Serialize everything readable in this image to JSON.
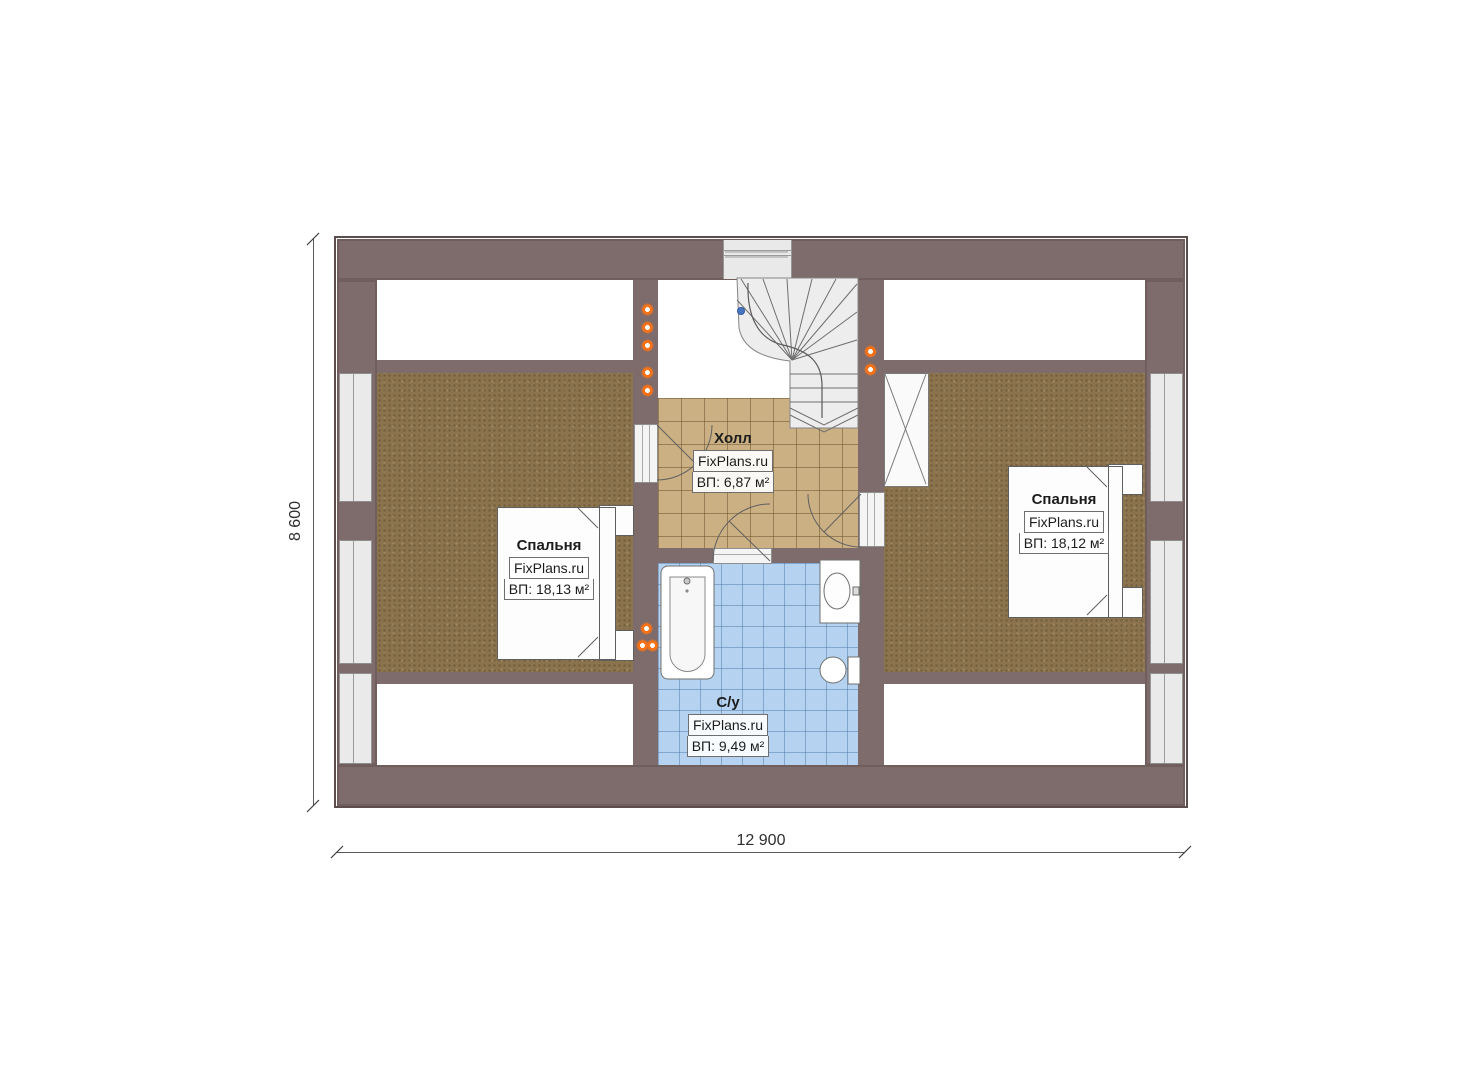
{
  "plan": {
    "type": "floor-plan",
    "rooms": {
      "bedroom_left": {
        "name": "Спальня",
        "brand": "FixPlans.ru",
        "area": "ВП: 18,13 м²"
      },
      "bedroom_right": {
        "name": "Спальня",
        "brand": "FixPlans.ru",
        "area": "ВП: 18,12 м²"
      },
      "hall": {
        "name": "Холл",
        "brand": "FixPlans.ru",
        "area": "ВП: 6,87 м²"
      },
      "bathroom": {
        "name": "С/у",
        "brand": "FixPlans.ru",
        "area": "ВП: 9,49 м²"
      }
    },
    "dimensions": {
      "height_label": "8 600",
      "width_label": "12 900"
    },
    "colors": {
      "wall": "#7e6b6b",
      "bedroom_floor": "#8a734d",
      "hall_tile": "#cbb084",
      "bathroom_tile": "#b5d3f1",
      "downlight": "#f97316",
      "walk_node": "#4a77c4"
    },
    "icons": {
      "downlight": "orange ceiling spot dot",
      "walk_node": "blue stair walk-line node",
      "stair_arrow": "double chevron at stair foot"
    }
  }
}
